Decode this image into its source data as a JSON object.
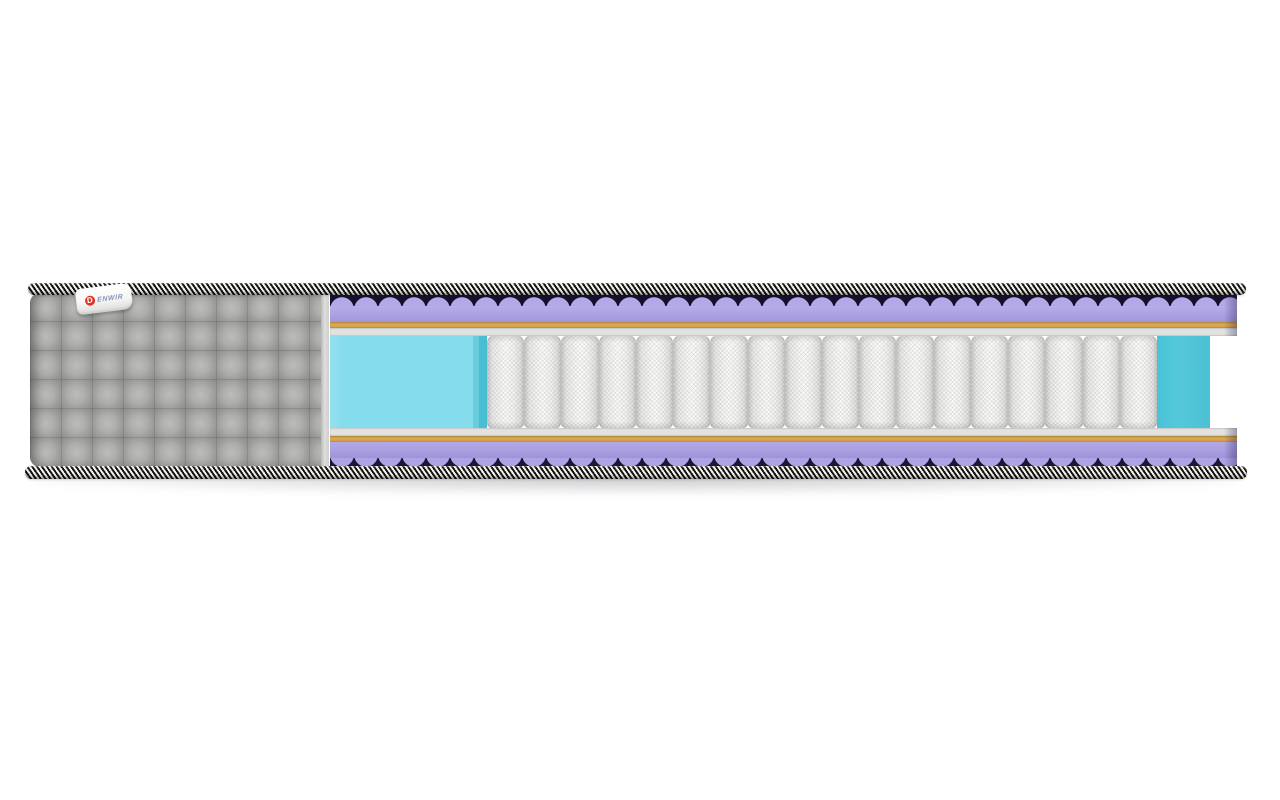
{
  "scene": {
    "type": "product-image",
    "subject": "mattress cross-section cutaway",
    "background_color": "#ffffff"
  },
  "brand": {
    "name": "DENWIR",
    "logo_letter": "D",
    "label_text": "ENWIR",
    "logo_color": "#e0342a",
    "label_text_color": "#8494ba",
    "tag_color": "#ffffff"
  },
  "mattress": {
    "cover": {
      "name": "grey quilted fabric cover",
      "color": "#a6a6a4"
    },
    "edge_tape": {
      "name": "black-white striped edge tape",
      "colors": [
        "#171511",
        "#f3f2ef"
      ]
    },
    "springs": {
      "count": 18,
      "color": "#f4f4f2",
      "style": "pocket spring coils"
    },
    "side_foam": {
      "left_color": "#85dcec",
      "right_color": "#55c9db"
    },
    "layers_top_to_bottom": [
      {
        "name": "wave-profile foam (top)",
        "color": "#b3a9e8",
        "shadow_color": "#17112e"
      },
      {
        "name": "purple foam slab (top)",
        "color": "#aba1e3"
      },
      {
        "name": "latex/coir thin layer (top)",
        "color": "#dcab54"
      },
      {
        "name": "felt pad (top)",
        "color": "#e2e2e0"
      },
      {
        "name": "spring core with side support foam",
        "color": "#f4f4f2"
      },
      {
        "name": "felt pad (bottom)",
        "color": "#e2e2e0"
      },
      {
        "name": "latex/coir thin layer (bottom)",
        "color": "#dcab54"
      },
      {
        "name": "purple foam slab (bottom)",
        "color": "#a79de0"
      },
      {
        "name": "wave-profile foam (bottom)",
        "color": "#aea4e5",
        "shadow_color": "#1c1638"
      }
    ]
  }
}
